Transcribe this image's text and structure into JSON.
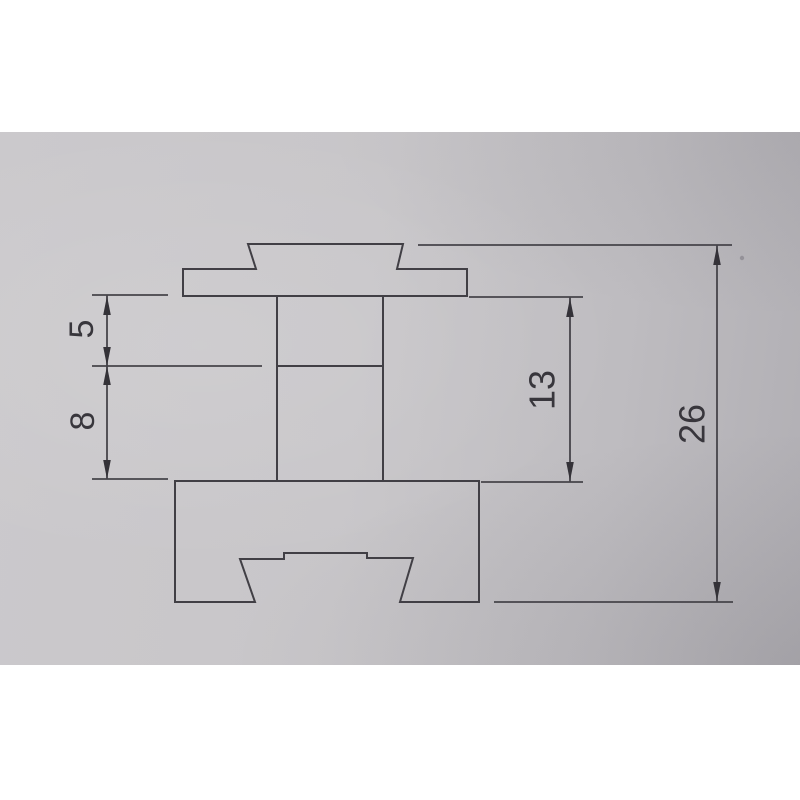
{
  "document": {
    "kind": "photographed technical drawing of an extrusion cross-section profile",
    "background_color": "#ffffff",
    "paper_color_left": "#cbc9cc",
    "paper_color_right": "#b1afb4",
    "line_color": "#413f45"
  },
  "drawing": {
    "parts": [
      {
        "name": "top-cap-with-dovetail-tenon"
      },
      {
        "name": "center-column"
      },
      {
        "name": "bottom-block-with-dovetail-groove"
      }
    ],
    "dimensions": [
      {
        "name": "upper-column-segment-height",
        "value": "5",
        "orientation": "vertical"
      },
      {
        "name": "lower-column-segment-height",
        "value": "8",
        "orientation": "vertical"
      },
      {
        "name": "column-total-height",
        "value": "13",
        "orientation": "vertical"
      },
      {
        "name": "overall-profile-height",
        "value": "26",
        "orientation": "vertical"
      }
    ]
  }
}
